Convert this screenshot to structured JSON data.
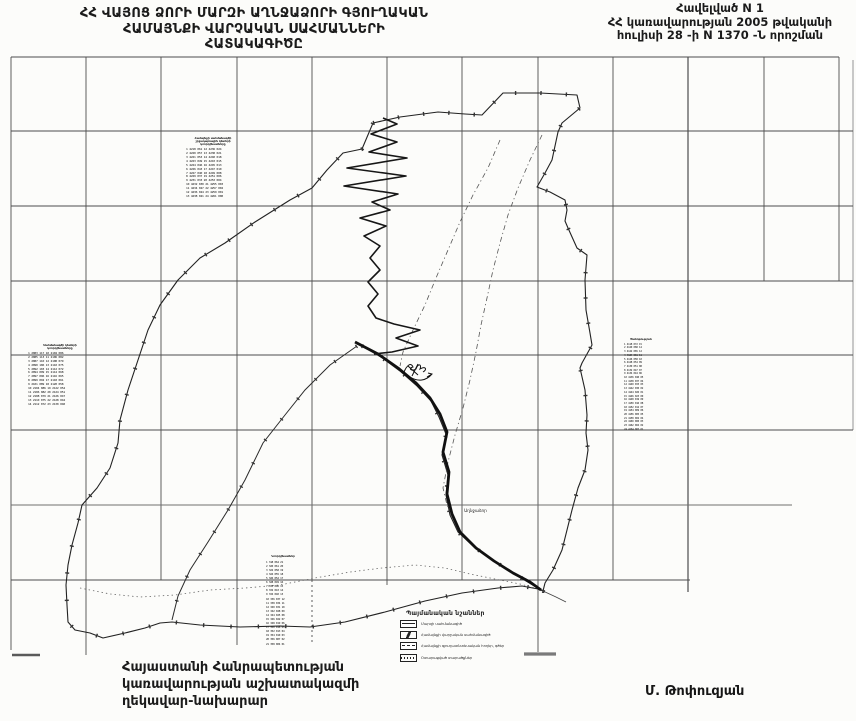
{
  "header": {
    "title": "ՀՀ ՎԱՅՈՑ ՁՈՐԻ ՄԱՐԶԻ ԱՂՆՋԱՁՈՐԻ ԳՅՈՒՂԱԿԱՆ\nՀԱՄԱՅՆՔԻ ՎԱՐՉԱԿԱՆ  ՍԱՀՄԱՆՆԵՐԻ\nՀԱՏԱԿԱԳԻԾԸ",
    "annex": "Հավելված N 1\nՀՀ կառավարության 2005 թվականի\nհուլիսի 28 -ի N 1370 -Ն որոշման"
  },
  "footer": {
    "issuer": "Հայաստանի Հանրապետության\nկառավարության աշխատակազմի\nղեկավար-նախարար",
    "signature": "Մ. Թոփուզյան"
  },
  "legend": {
    "title": "Պայմանական նշաններ",
    "items": [
      "Մարզի սահմանագիծ",
      "Համայնքի վարչական սահմանագիծ",
      "Համայնքի գյուղատնտեսական հողեր, գծեր",
      "Օտարացված տարածքներ"
    ]
  },
  "map": {
    "village_label": "Աղնջաձոր",
    "tables": {
      "A": {
        "header": "Համայնքի սահմանագծի\nշրջադարձային կետերի\nկոորդինատները",
        "rows": "1 4218 061  12 4236 024\n2 4220 057  13 4238 021\n3 4221 053  14 4240 018\n4 4223 049  15 4243 015\n5 4224 046  16 4245 013\n6 4226 043  17 4247 010\n7 4227 040  18 4249 008\n8 4229 037  19 4251 006\n9 4231 033  20 4253 004\n10 4232 030 21 4255 003\n11 4234 027 22 4257 002\n12 4236 024 23 4259 001\n13 4238 021 24 4261 000"
      },
      "B": {
        "header": "Սահմանագծի կետերի\nկոորդինատները",
        "rows": "1 2083 117  10 2104 086\n2 2085 113  11 2106 082\n3 2087 110  12 2108 079\n4 2090 106  13 2110 075\n5 2092 103  14 2112 072\n6 2094 099  15 2114 068\n7 2097 096  16 2116 065\n8 2099 092  17 2118 061\n9 2101 089  18 2120 058\n10 2104 086 19 2122 054\n11 2106 082 20 2124 051\n12 2108 079 21 2126 047\n13 2110 075 22 2128 044\n14 2112 072 23 2130 040"
      },
      "C": {
        "header": "Ծանոթություն",
        "rows": "1 4118 072 15\n2 4120 068 14\n3 4122 065 12\n4 4124 061 11\n5 4126 058 10\n6 4128 054 09\n7 4130 051 08\n8 4132 047 07\n9 4134 044 06\n10 4136 040 05\n11 4138 037 04\n12 4140 033 03\n13 4142 030 02\n14 4144 026 01\n15 4146 023 00\n16 4148 019 09\n17 4150 016 08\n18 4152 012 07\n19 4154 009 06\n20 4156 005 05\n21 4158 002 04\n22 4160 000 03\n23 4162 004 02\n24 4164 007 01"
      },
      "D": {
        "header": "Կոորդինատներ",
        "rows": "1 318 064 21\n2 320 061 20\n3 322 058 19\n4 324 055 18\n5 326 052 17\n6 328 049 16\n7 330 046 15\n8 332 043 14\n9 334 040 13\n10 336 037 12\n11 338 034 11\n12 340 031 10\n13 342 028 09\n14 344 025 08\n15 346 022 07\n16 348 019 06\n17 350 016 05\n18 352 013 04\n19 354 010 03\n20 356 007 02\n21 358 004 01"
      }
    }
  },
  "colors": {
    "paper": "#fcfcfa",
    "ink": "#1b1b1b",
    "grid_dark": "#4d4d4d",
    "grid_gray": "#8a8a8a"
  }
}
